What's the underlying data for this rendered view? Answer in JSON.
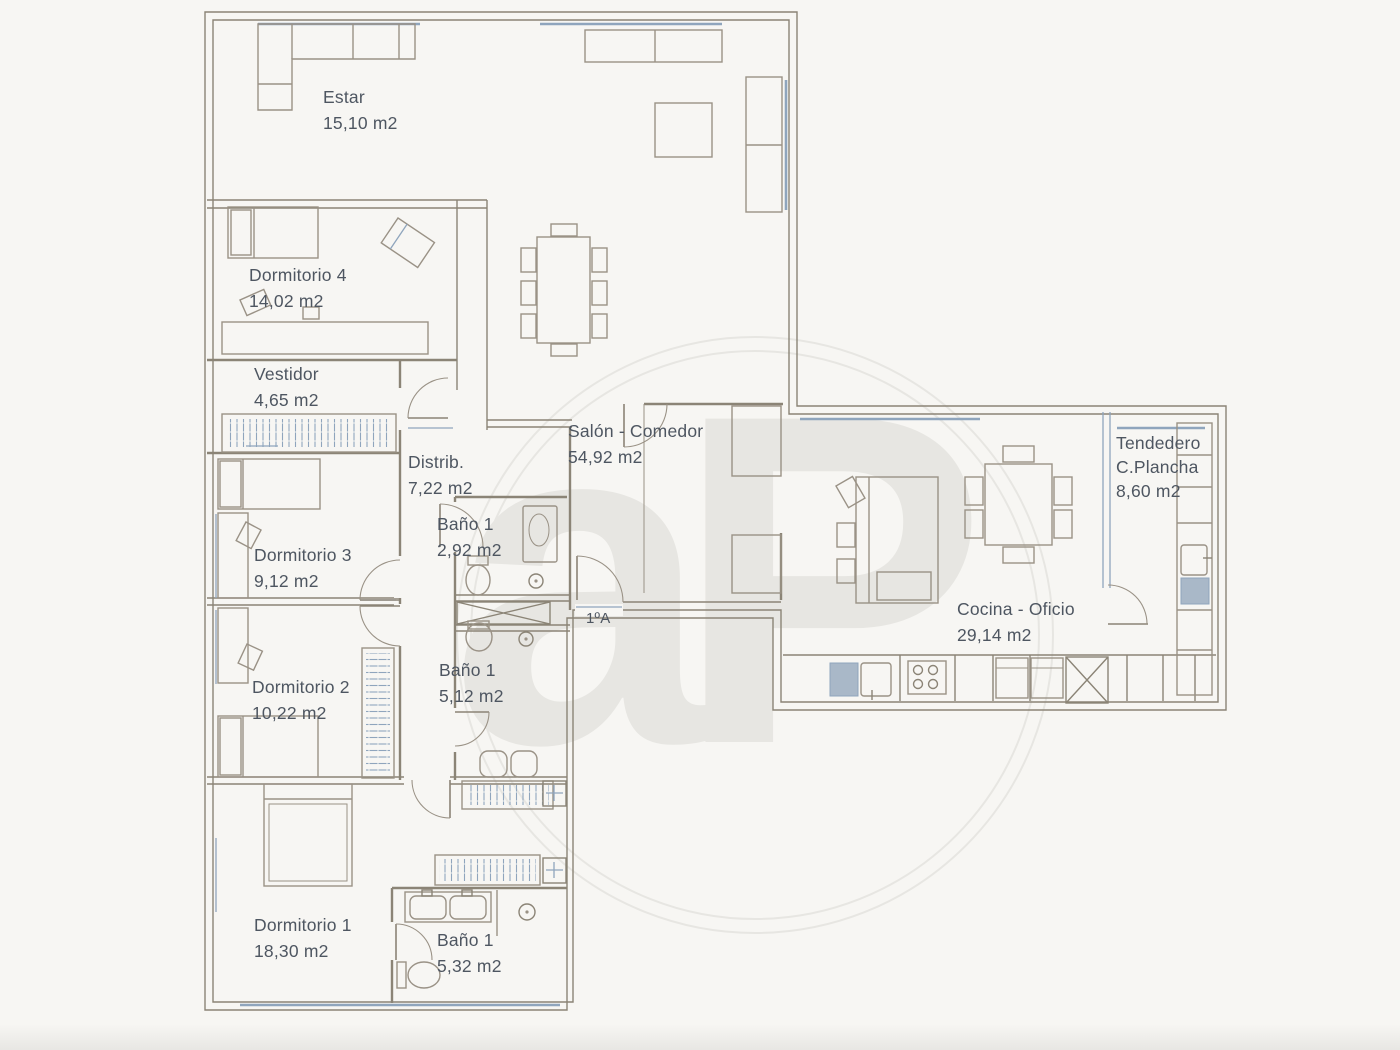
{
  "plan": {
    "watermark": "aP",
    "entrance_unit": "1ºA",
    "rooms": {
      "estar": {
        "name": "Estar",
        "area": "15,10 m2"
      },
      "dormitorio4": {
        "name": "Dormitorio 4",
        "area": "14,02 m2"
      },
      "vestidor": {
        "name": "Vestidor",
        "area": "4,65 m2"
      },
      "distribuidor": {
        "name": "Distrib.",
        "area": "7,22 m2"
      },
      "bano_superior": {
        "name": "Baño 1",
        "area": "2,92 m2"
      },
      "salon_comedor": {
        "name": "Salón - Comedor",
        "area": "54,92 m2"
      },
      "dormitorio3": {
        "name": "Dormitorio 3",
        "area": "9,12 m2"
      },
      "dormitorio2": {
        "name": "Dormitorio 2",
        "area": "10,22 m2"
      },
      "bano_medio": {
        "name": "Baño 1",
        "area": "5,12 m2"
      },
      "dormitorio1": {
        "name": "Dormitorio 1",
        "area": "18,30 m2"
      },
      "bano_inferior": {
        "name": "Baño 1",
        "area": "5,32 m2"
      },
      "cocina_oficio": {
        "name": "Cocina - Oficio",
        "area": "29,14 m2"
      },
      "tendedero": {
        "name": "Tendedero",
        "sub": "C.Plancha",
        "area": "8,60 m2"
      }
    },
    "colors": {
      "paper": "#f7f6f3",
      "wall": "#8b8476",
      "furniture": "#9a9286",
      "fixture": "#8fa5bd",
      "fixture_fill": "#a9b8c8",
      "text": "#4e5661",
      "watermark": "#e7e6e2"
    }
  }
}
